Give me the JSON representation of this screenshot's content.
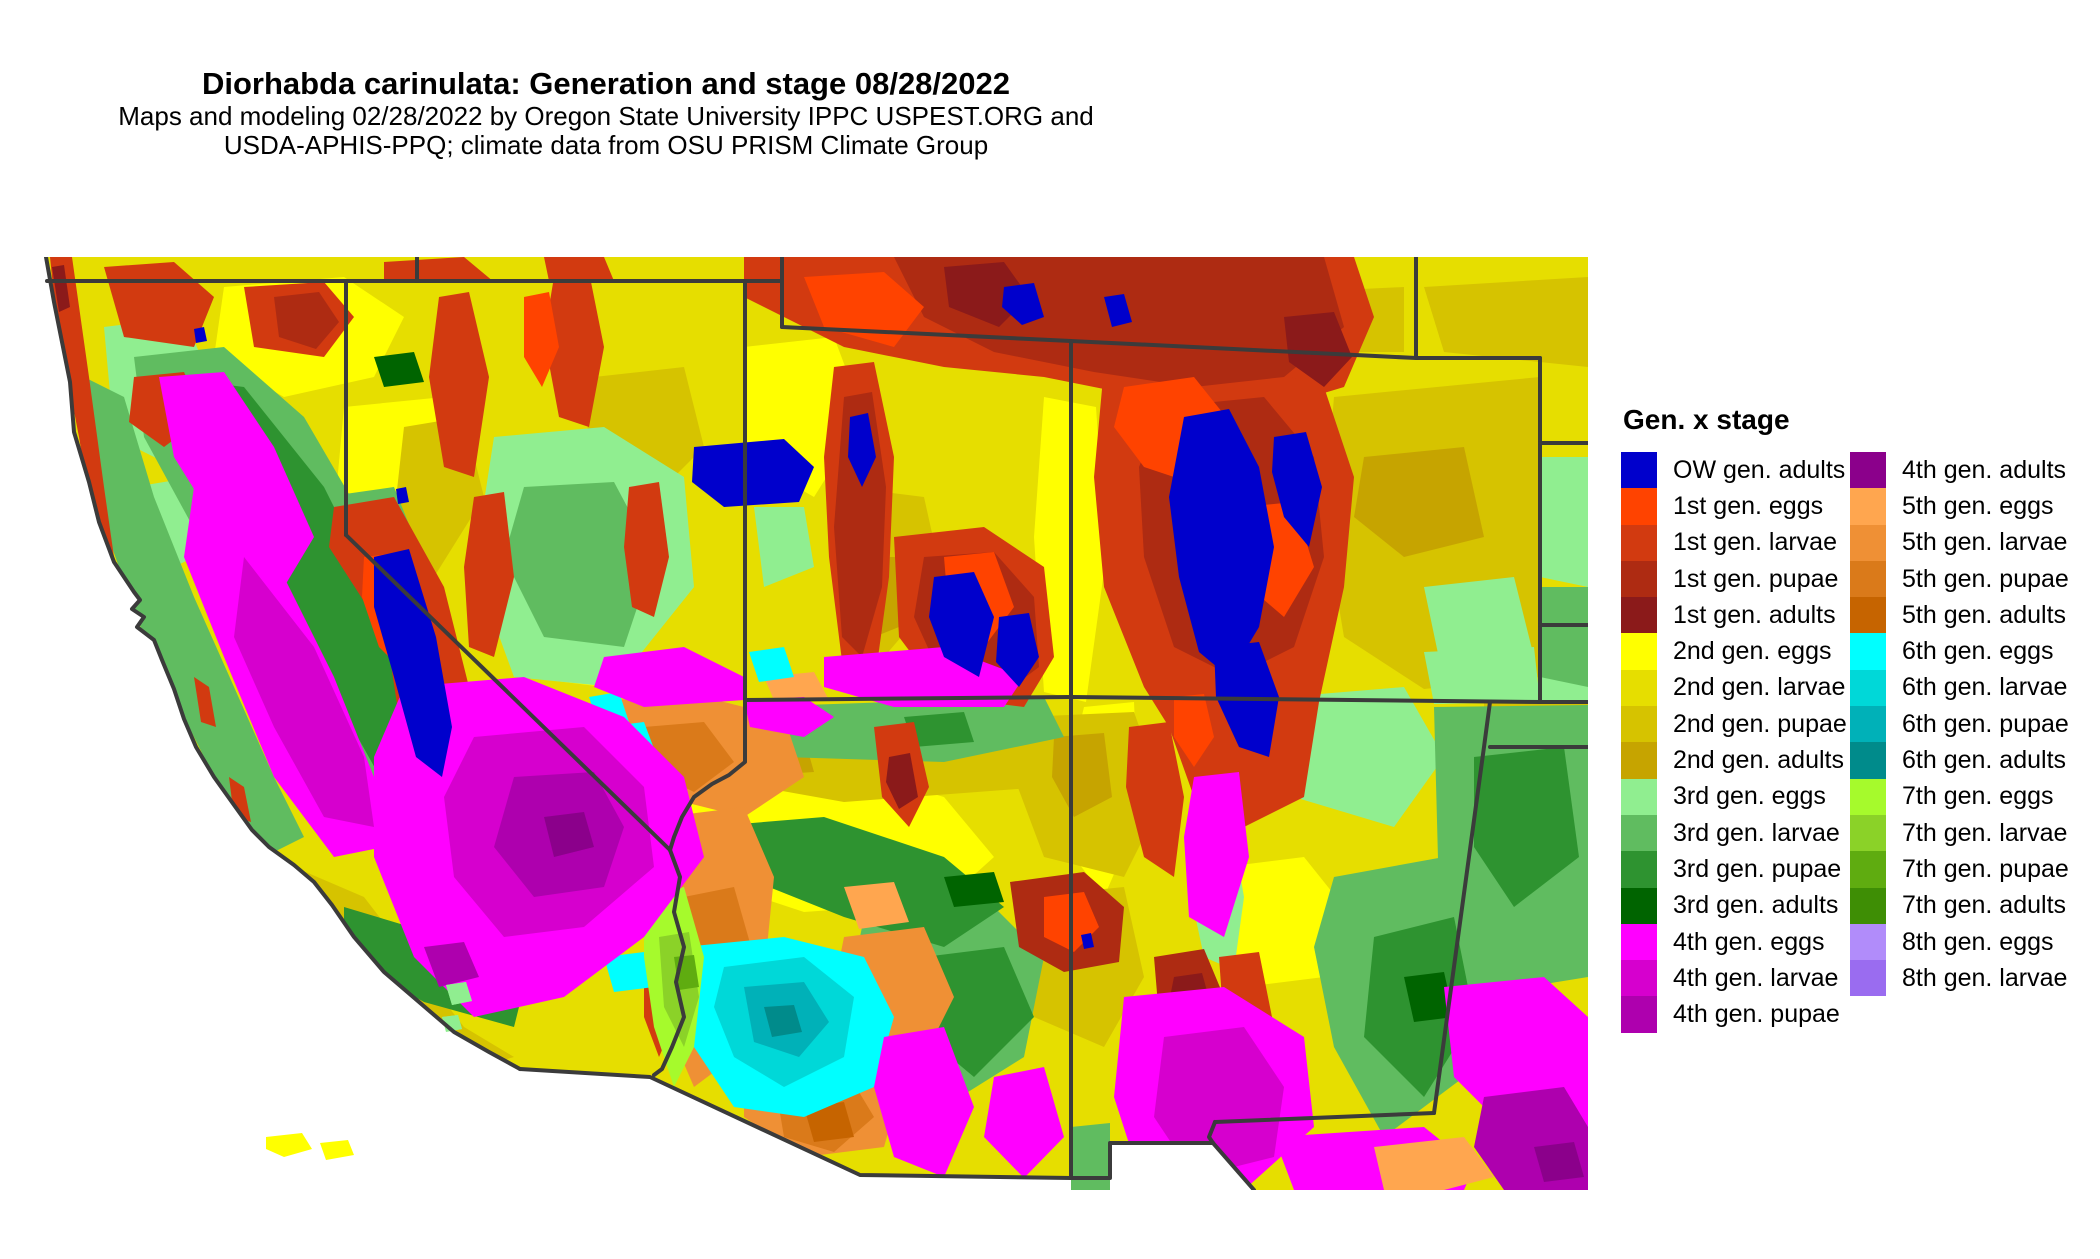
{
  "header": {
    "title": "Diorhabda carinulata: Generation and stage 08/28/2022",
    "subtitle_line1": "Maps and modeling 02/28/2022 by Oregon State University IPPC USPEST.ORG and",
    "subtitle_line2": "USDA-APHIS-PPQ; climate data from OSU PRISM Climate Group"
  },
  "legend": {
    "title": "Gen. x stage",
    "column1": [
      {
        "label": "OW gen. adults",
        "color": "#0000CC"
      },
      {
        "label": "1st gen. eggs",
        "color": "#FF4300"
      },
      {
        "label": "1st gen. larvae",
        "color": "#D23A10"
      },
      {
        "label": "1st gen. pupae",
        "color": "#AE2B12"
      },
      {
        "label": "1st gen. adults",
        "color": "#8B1A1A"
      },
      {
        "label": "2nd gen. eggs",
        "color": "#FFFF00"
      },
      {
        "label": "2nd gen. larvae",
        "color": "#E6DE00"
      },
      {
        "label": "2nd gen. pupae",
        "color": "#D6C300"
      },
      {
        "label": "2nd gen. adults",
        "color": "#C6A400"
      },
      {
        "label": "3rd gen. eggs",
        "color": "#90EE90"
      },
      {
        "label": "3rd gen. larvae",
        "color": "#60BC60"
      },
      {
        "label": "3rd gen. pupae",
        "color": "#2E9330"
      },
      {
        "label": "3rd gen. adults",
        "color": "#006400"
      },
      {
        "label": "4th gen. eggs",
        "color": "#FF00FF"
      },
      {
        "label": "4th gen. larvae",
        "color": "#D600CE"
      },
      {
        "label": "4th gen. pupae",
        "color": "#AE00AE"
      }
    ],
    "column2": [
      {
        "label": "4th gen. adults",
        "color": "#8B008B"
      },
      {
        "label": "5th gen. eggs",
        "color": "#FFA64F"
      },
      {
        "label": "5th gen. larvae",
        "color": "#EF9035"
      },
      {
        "label": "5th gen. pupae",
        "color": "#DA7A1A"
      },
      {
        "label": "5th gen. adults",
        "color": "#C66400"
      },
      {
        "label": "6th gen. eggs",
        "color": "#00FFFF"
      },
      {
        "label": "6th gen. larvae",
        "color": "#00D8D8"
      },
      {
        "label": "6th gen. pupae",
        "color": "#00B1B8"
      },
      {
        "label": "6th gen. adults",
        "color": "#008B8B"
      },
      {
        "label": "7th gen. eggs",
        "color": "#A6FA2C"
      },
      {
        "label": "7th gen. larvae",
        "color": "#8BD228"
      },
      {
        "label": "7th gen. pupae",
        "color": "#5FAC10"
      },
      {
        "label": "7th gen. adults",
        "color": "#3E8E05"
      },
      {
        "label": "8th gen. eggs",
        "color": "#B18CFA"
      },
      {
        "label": "8th gen. larvae",
        "color": "#9A6CF0"
      }
    ]
  },
  "map": {
    "border_color": "#3B3B3B",
    "ocean_color": "#FFFFFF",
    "palette": {
      "ow_adults": "#0000CC",
      "g1_eggs": "#FF4300",
      "g1_larvae": "#D23A10",
      "g1_pupae": "#AE2B12",
      "g1_adults": "#8B1A1A",
      "g2_eggs": "#FFFF00",
      "g2_larvae": "#E6DE00",
      "g2_pupae": "#D6C300",
      "g2_adults": "#C6A400",
      "g3_eggs": "#90EE90",
      "g3_larvae": "#60BC60",
      "g3_pupae": "#2E9330",
      "g3_adults": "#006400",
      "g4_eggs": "#FF00FF",
      "g4_larvae": "#D600CE",
      "g4_pupae": "#AE00AE",
      "g4_adults": "#8B008B",
      "g5_eggs": "#FFA64F",
      "g5_larvae": "#EF9035",
      "g5_pupae": "#DA7A1A",
      "g5_adults": "#C66400",
      "g6_eggs": "#00FFFF",
      "g6_larvae": "#00D8D8",
      "g6_pupae": "#00B1B8",
      "g6_adults": "#008B8B",
      "g7_eggs": "#A6FA2C",
      "g7_larvae": "#8BD228",
      "g7_pupae": "#5FAC10",
      "g7_adults": "#3E8E05",
      "g8_eggs": "#B18CFA",
      "g8_larvae": "#9A6CF0"
    }
  }
}
